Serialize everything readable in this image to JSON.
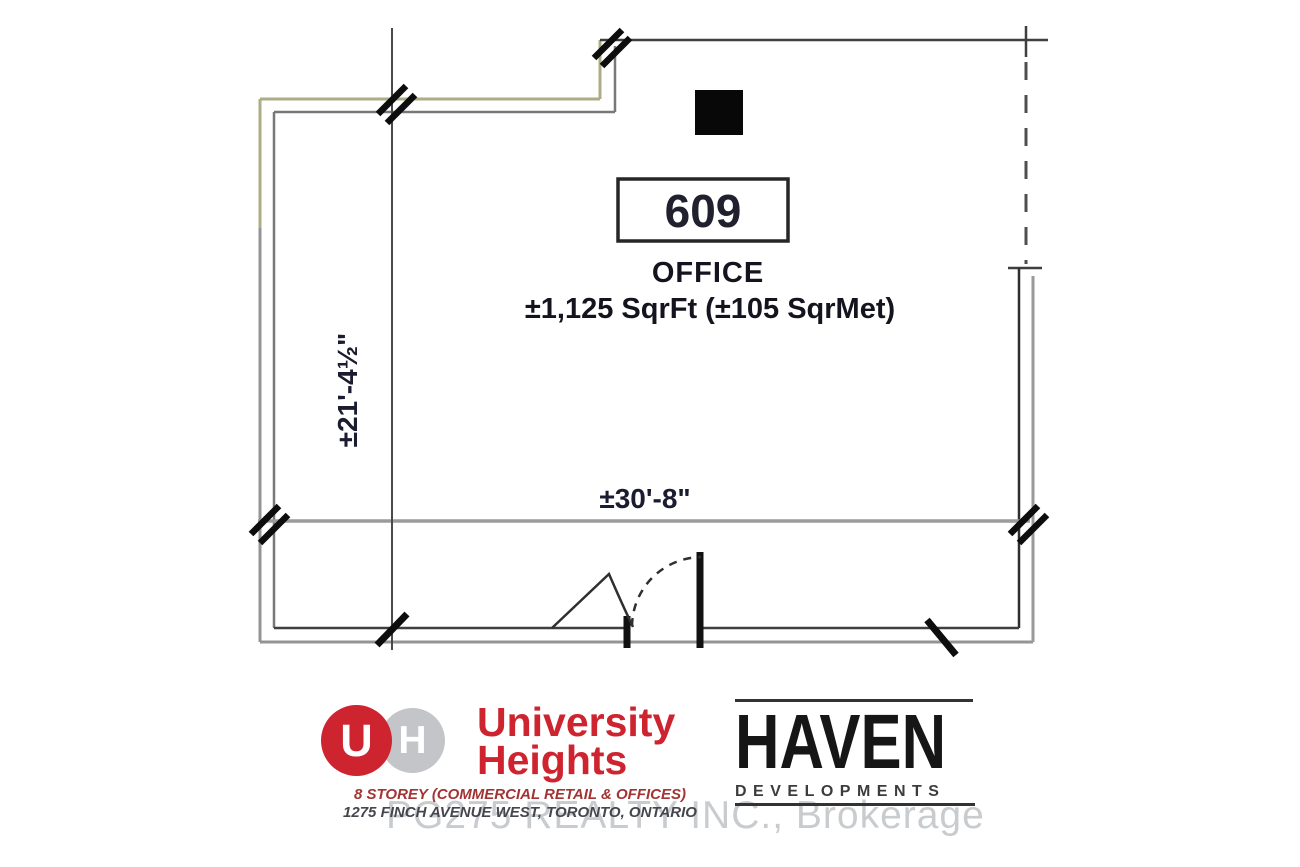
{
  "plan": {
    "unit_number": "609",
    "unit_label": "OFFICE",
    "area_text": "±1,125 SqrFt (±105 SqrMet)",
    "width_dim": "±30'-8\"",
    "height_dim": "±21'-4½\"",
    "wall_accent_color": "#adad85",
    "text_color": "#15151f"
  },
  "university_heights": {
    "initial_u": "U",
    "initial_h": "H",
    "name_line1": "University",
    "name_line2": "Heights",
    "tagline": "8 STOREY (COMMERCIAL RETAIL & OFFICES)",
    "address": "1275 FINCH AVENUE WEST, TORONTO, ONTARIO",
    "brand_red": "#ce2430",
    "circle_gray": "#c3c5c8"
  },
  "haven": {
    "name": "HAVEN",
    "subtitle": "DEVELOPMENTS"
  },
  "watermark": {
    "text": "PG275 REALTY INC., Brokerage"
  }
}
